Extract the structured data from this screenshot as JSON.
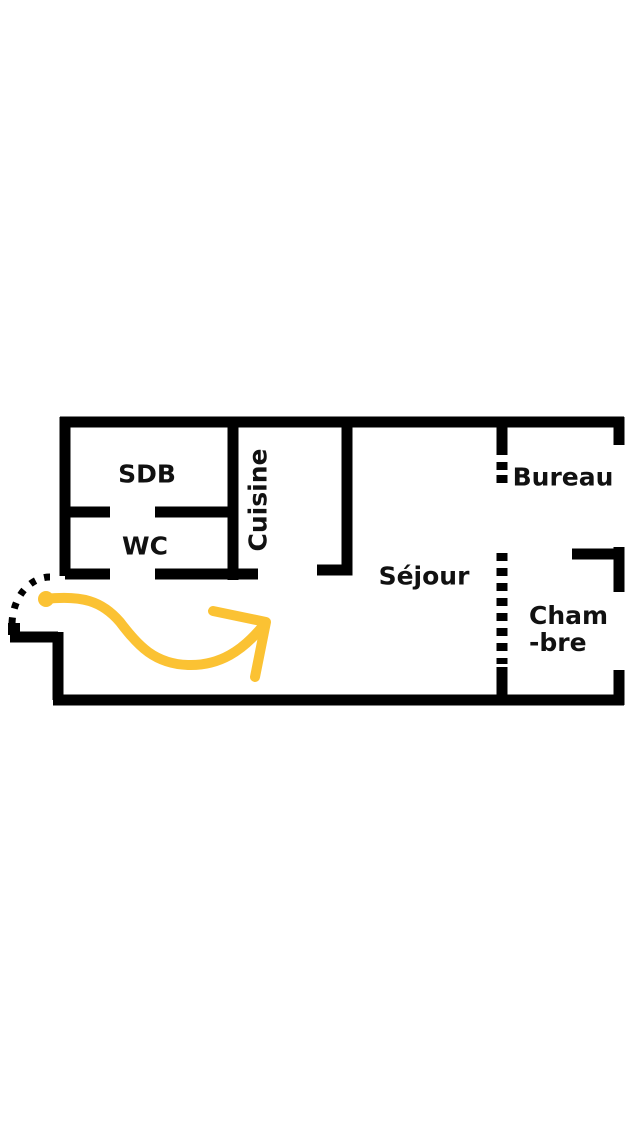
{
  "diagram": {
    "type": "apartment-floor-plan",
    "labels": {
      "sdb": "SDB",
      "wc": "WC",
      "cuisine": "Cuisine",
      "sejour": "Séjour",
      "bureau": "Bureau",
      "chambre_line1": "Cham",
      "chambre_line2": "-bre"
    },
    "colors": {
      "wall": "#000000",
      "arrow": "#FBC233",
      "background": "#FFFFFF"
    },
    "annotations": {
      "entry_door": "dashed-quarter-arc-door-swing",
      "entry_path": "yellow-curved-arrow-from-entrance-into-sejour"
    }
  }
}
